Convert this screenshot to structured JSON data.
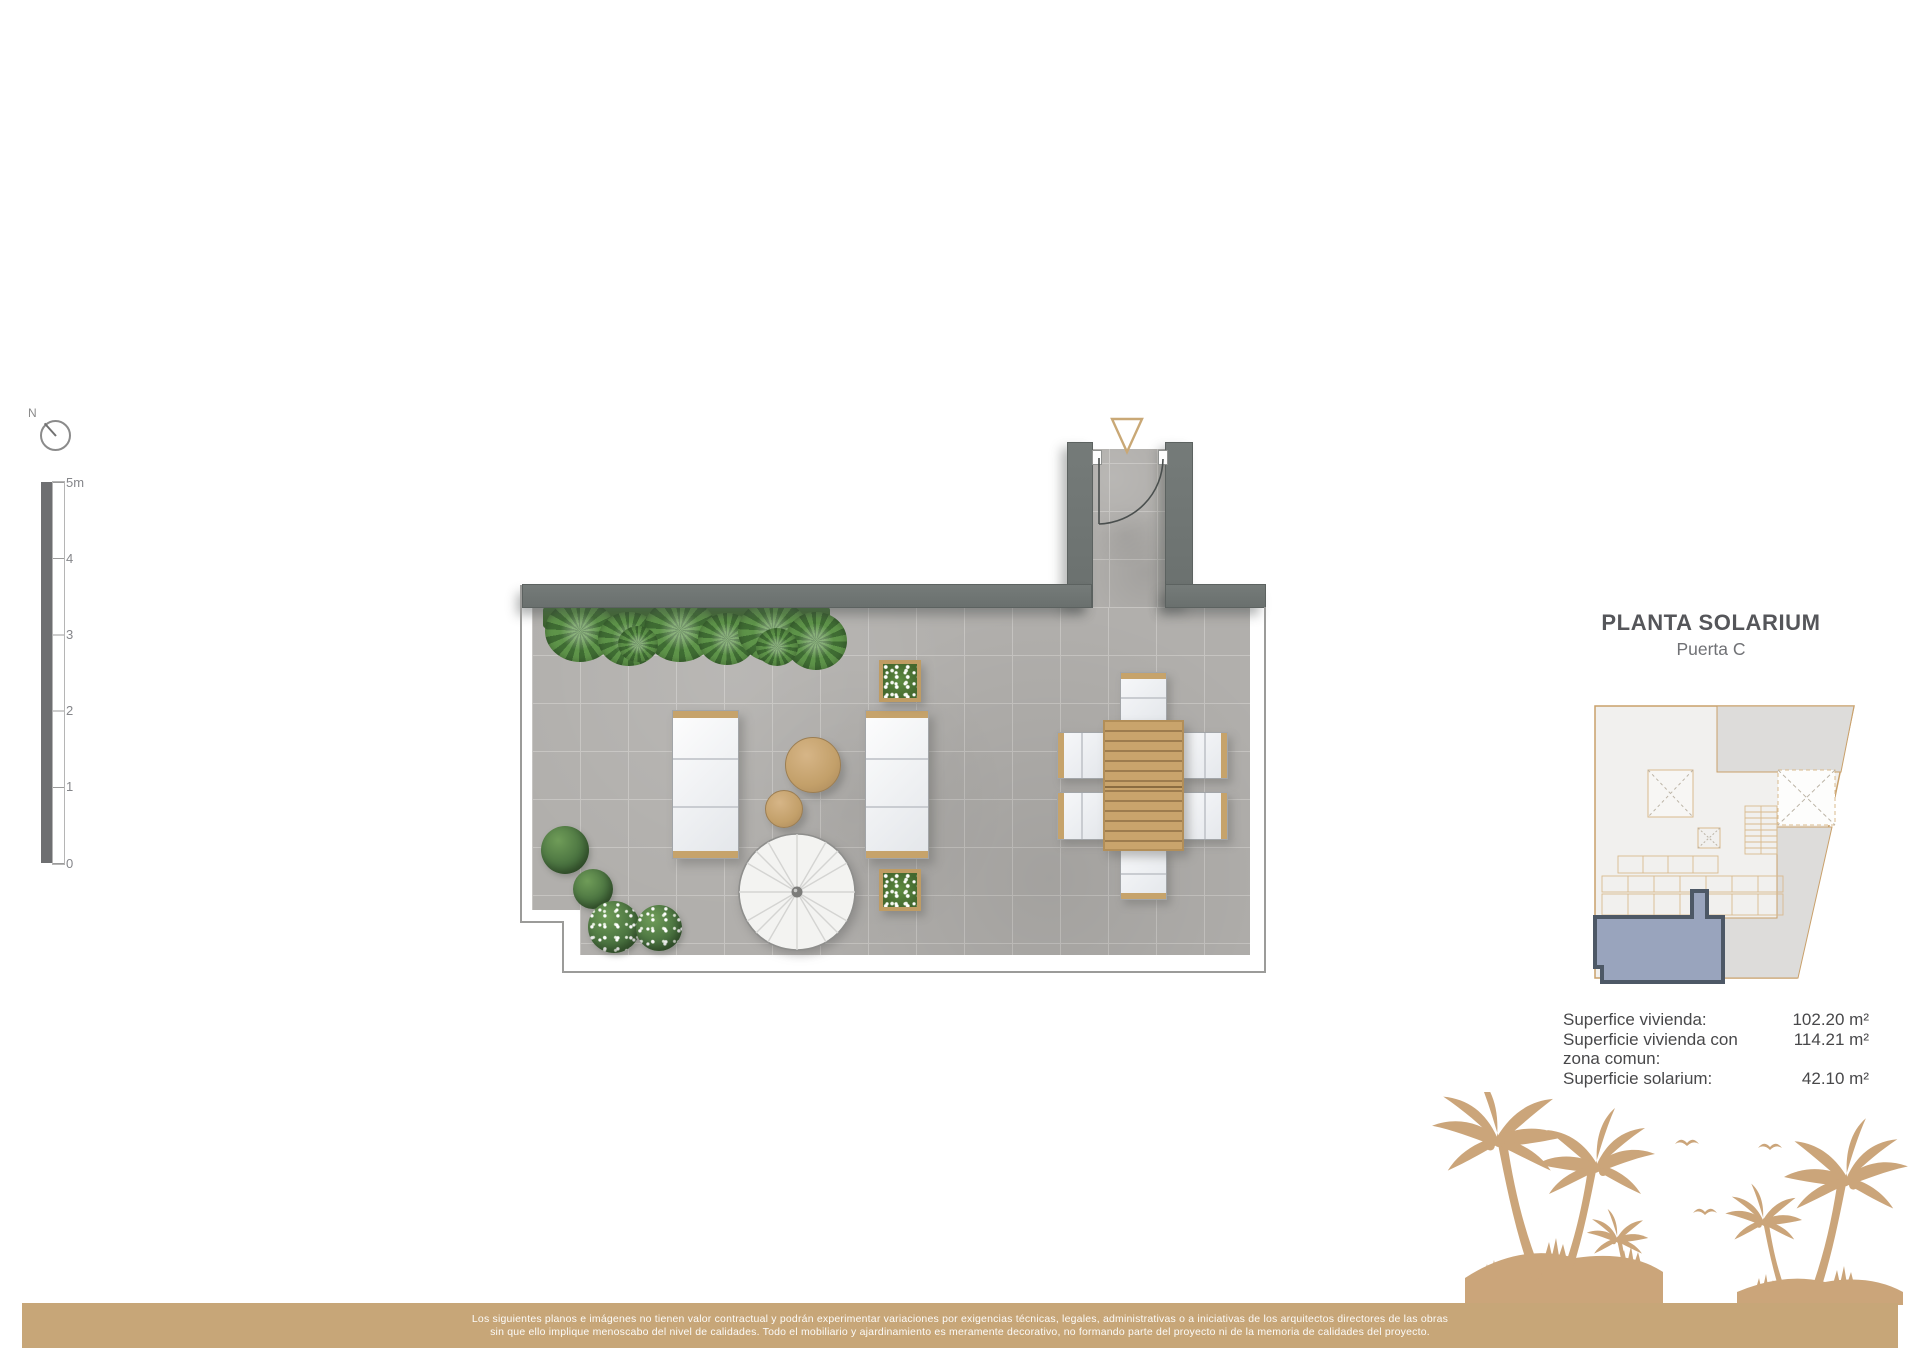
{
  "compass": {
    "label": "N"
  },
  "scale_bar": {
    "ticks": [
      "5m",
      "4",
      "3",
      "2",
      "1",
      "0"
    ]
  },
  "plan": {
    "objects": [
      "perimeter-walls",
      "entrance-corridor",
      "entrance-door",
      "terrace-floor",
      "hedge",
      "bushes",
      "sun-lounger-left",
      "sun-lounger-right",
      "side-table-large",
      "side-table-small",
      "parasol",
      "flower-planter-top",
      "flower-planter-bottom",
      "dining-table",
      "dining-chairs"
    ],
    "colors": {
      "wall": "#6f7674",
      "floor": "#b1afac",
      "grout": "#c6c4c1",
      "plant_green": "#4f8240",
      "wood": "#c8a36b",
      "accent_tan": "#c7a678"
    }
  },
  "panel": {
    "title": "PLANTA SOLARIUM",
    "subtitle": "Puerta C",
    "minimap": {
      "highlight_color": "#99a4bd",
      "outline_color": "#c9a06a",
      "highlight_border": "#4d5866"
    },
    "areas": [
      {
        "label": "Superfice vivienda:",
        "value": "102.20 m²"
      },
      {
        "label": "Superficie vivienda con zona comun:",
        "value": "114.21 m²"
      },
      {
        "label": "Superficie solarium:",
        "value": "42.10 m²"
      }
    ]
  },
  "footer": {
    "line1": "Los siguientes planos e imágenes no tienen valor contractual y podrán experimentar variaciones por exigencias técnicas, legales, administrativas o a iniciativas de los arquitectos directores de las obras",
    "line2": "sin que ello implique menoscabo del nivel de calidades. Todo el mobiliario y ajardinamiento es meramente decorativo, no formando parte del proyecto ni de la memoria de calidades del proyecto."
  }
}
